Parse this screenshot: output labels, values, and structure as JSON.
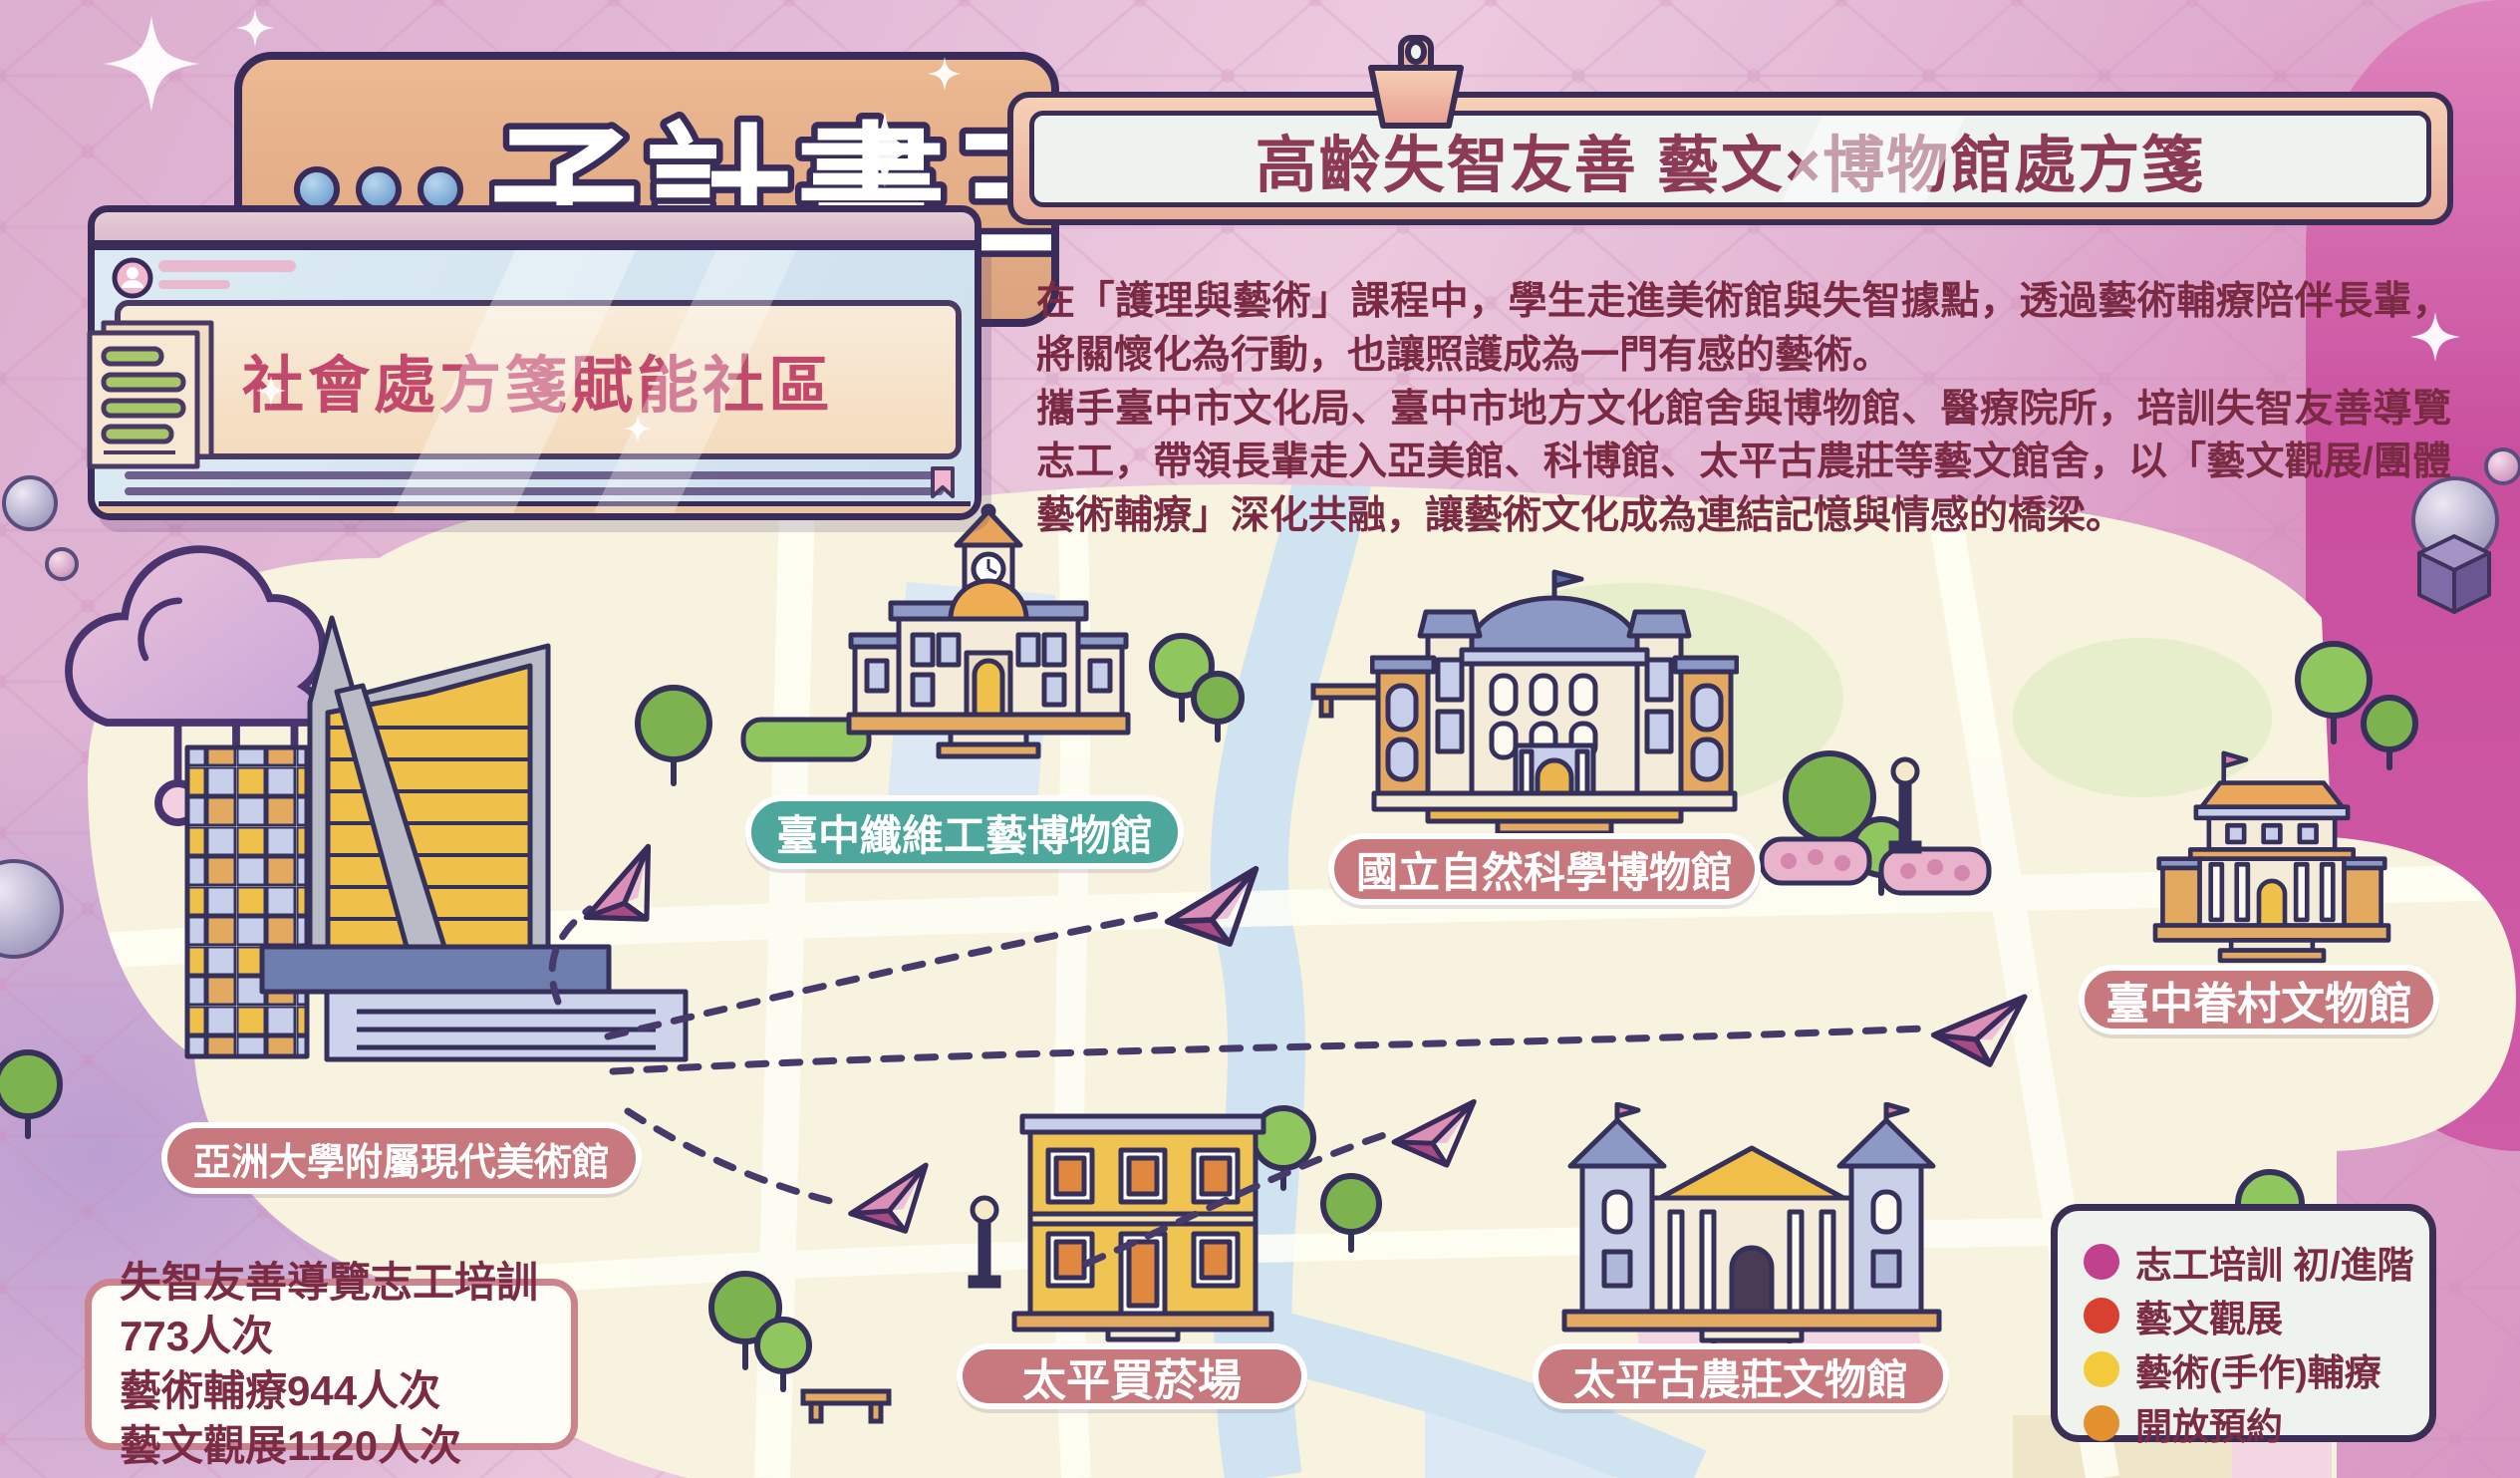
{
  "banner": {
    "title": "子計畫三"
  },
  "window": {
    "title": "社會處方箋賦能社區"
  },
  "clipboard": {
    "title": "高齡失智友善 藝文×博物館處方箋"
  },
  "intro": {
    "p1": "在「護理與藝術」課程中，學生走進美術館與失智據點，透過藝術輔療陪伴長輩，將關懷化為行動，也讓照護成為一門有感的藝術。",
    "p2": "攜手臺中市文化局、臺中市地方文化館舍與博物館、醫療院所，培訓失智友善導覽志工，帶領長輩走入亞美館、科博館、太平古農莊等藝文館舍，以「藝文觀展/團體藝術輔療」深化共融，讓藝術文化成為連結記憶與情感的橋梁。"
  },
  "map": {
    "sites": [
      {
        "label": "臺中纖維工藝博物館",
        "pill_color": "#4da79c"
      },
      {
        "label": "國立自然科學博物館",
        "pill_color": "#c8797e"
      },
      {
        "label": "臺中眷村文物館",
        "pill_color": "#c8797e"
      },
      {
        "label": "亞洲大學附屬現代美術館",
        "pill_color": "#c8797e"
      },
      {
        "label": "太平買菸場",
        "pill_color": "#c8797e"
      },
      {
        "label": "太平古農莊文物館",
        "pill_color": "#c8797e"
      }
    ]
  },
  "stats": {
    "lines": [
      "失智友善導覽志工培訓773人次",
      "藝術輔療944人次",
      "藝文觀展1120人次"
    ]
  },
  "legend": {
    "items": [
      {
        "label": "志工培訓 初/進階",
        "color": "#c2418d"
      },
      {
        "label": "藝文觀展",
        "color": "#d8402f"
      },
      {
        "label": "藝術(手作)輔療",
        "color": "#f2ca3b"
      },
      {
        "label": "開放預約",
        "color": "#e3902f"
      }
    ]
  },
  "icons": {
    "banner_dots": "three-dots",
    "clipboard_clip": "clipboard-clip",
    "window_avatar": "user-avatar",
    "window_bookmark": "bookmark",
    "route_marker": "paper-plane",
    "decorations": [
      "sparkle",
      "circuit-cloud",
      "sphere",
      "cube",
      "tree",
      "lamp",
      "bench",
      "hedge"
    ]
  }
}
